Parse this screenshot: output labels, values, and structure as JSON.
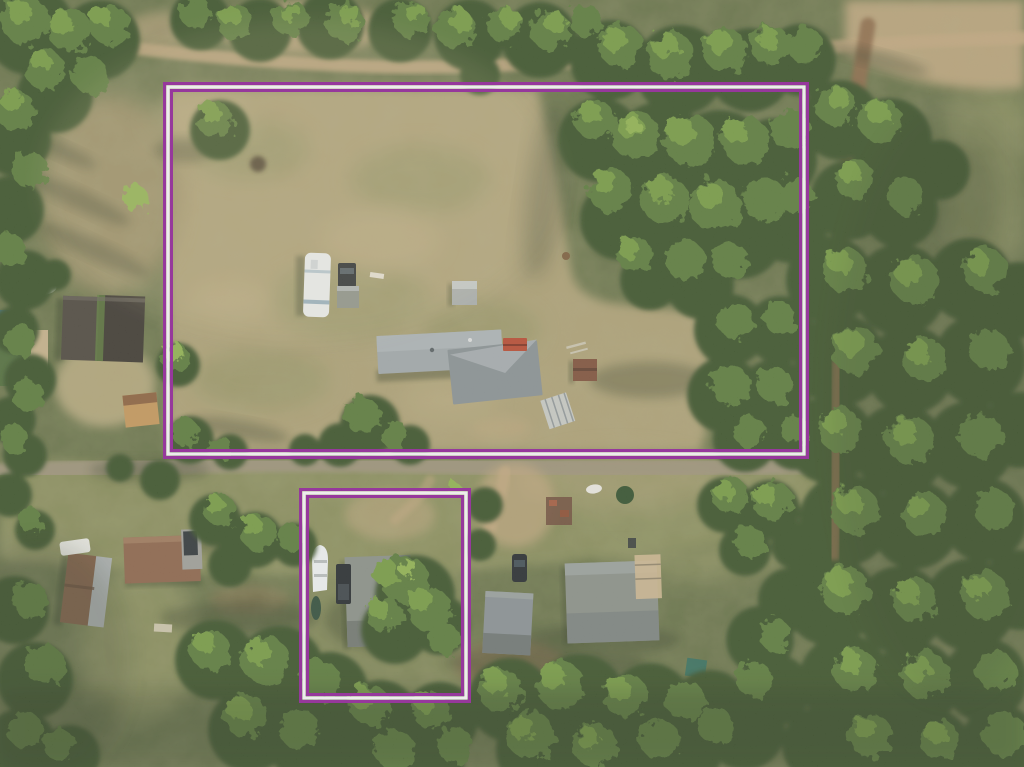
{
  "scene": {
    "description": "Aerial drone photo of a wooded rural property with two parcel boundaries outlined in purple and white",
    "colors": {
      "base_green": "#5f6b41",
      "field_tan": "#ab9d72",
      "field_olive": "#868b58",
      "field_dry": "#9a8c63",
      "field_light": "#bcab80",
      "dirt_sand": "#c0a57d",
      "dirt_brown": "#8a6847",
      "road_gray": "#9b9178",
      "canopy_dark": "#394f28",
      "canopy_mid": "#587838",
      "canopy_light": "#739840",
      "canopy_bright": "#8db04e",
      "shadow_green": "#26311a",
      "boundary_purple": "#8e1d96",
      "boundary_white": "#f7f3f8",
      "roof_gray": "#9ea5a8",
      "roof_gray_dark": "#868e92",
      "roof_small": "#878d85",
      "rv_white": "#eaeef0",
      "rv_blue": "#7e9db2",
      "red_trailer": "#b5472f",
      "shed_brown": "#7c4e38",
      "shed_tan": "#c29459",
      "barn_dark": "#4b453c",
      "barn_dark2": "#3a352e",
      "ridge_green": "#5c7a3c",
      "green_roof": "#4e6b3a",
      "deck_tan": "#cdb68f",
      "brown_roof": "#8a6148",
      "shingle_brown": "#7b5940",
      "metal_gray": "#a6abab",
      "boat_white": "#edf0f1",
      "vehicle_dark": "#22272b",
      "teal_shed": "#2f6b5c",
      "greenhouse_gray": "#c9ced1",
      "panel_dark": "#2d3337"
    },
    "features": [
      "main-parcel-boundary",
      "secondary-parcel-boundary",
      "main-house",
      "rv-camper",
      "pickup-truck",
      "small-shed",
      "red-trailer",
      "brown-shed",
      "greenhouse-frame",
      "left-barn",
      "green-roof-house",
      "tan-shed",
      "bottom-left-barn",
      "bottom-left-house",
      "boat",
      "secondary-house",
      "bottom-middle-house",
      "bottom-middle-house-2",
      "black-car",
      "burn-trailer",
      "propane-tank",
      "teal-shed",
      "dirt-roads",
      "tree-canopy"
    ]
  }
}
